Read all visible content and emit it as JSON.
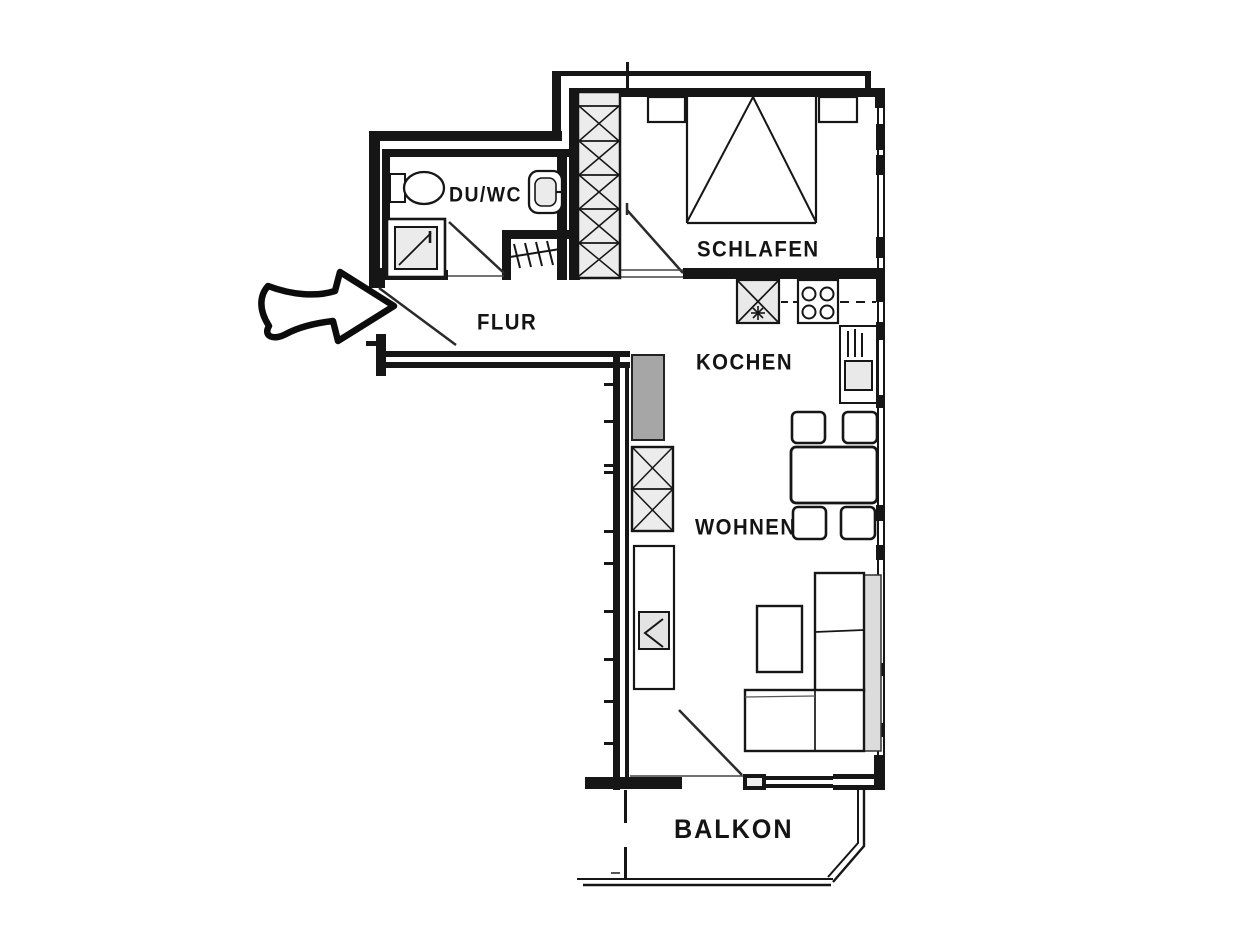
{
  "plan": {
    "type": "floor-plan",
    "rooms": [
      {
        "id": "du_wc",
        "label": "DU/WC"
      },
      {
        "id": "schlafen",
        "label": "SCHLAFEN"
      },
      {
        "id": "flur",
        "label": "FLUR"
      },
      {
        "id": "kochen",
        "label": "KOCHEN"
      },
      {
        "id": "wohnen",
        "label": "WOHNEN"
      },
      {
        "id": "balkon",
        "label": "BALKON"
      }
    ],
    "fixtures": [
      "entrance-arrow-icon",
      "toilet-icon",
      "washbasin-icon",
      "shower-icon",
      "radiator-icon",
      "wardrobe-icon",
      "bed-icon",
      "nightstand-icon",
      "kitchen-sink-icon",
      "stove-icon",
      "kitchen-tall-unit-icon",
      "dining-table-icon",
      "chair-icon",
      "tall-cabinet-icon",
      "shelf-closet-icon",
      "sideboard-icon",
      "tv-icon",
      "coffee-table-icon",
      "corner-sofa-icon",
      "balcony-railing-icon"
    ],
    "colors": {
      "line": "#161616",
      "light_fill": "#ebebeb",
      "gray_fill": "#a6a6a6",
      "sofa_back_fill": "#dcdcdc",
      "background": "#ffffff"
    }
  }
}
